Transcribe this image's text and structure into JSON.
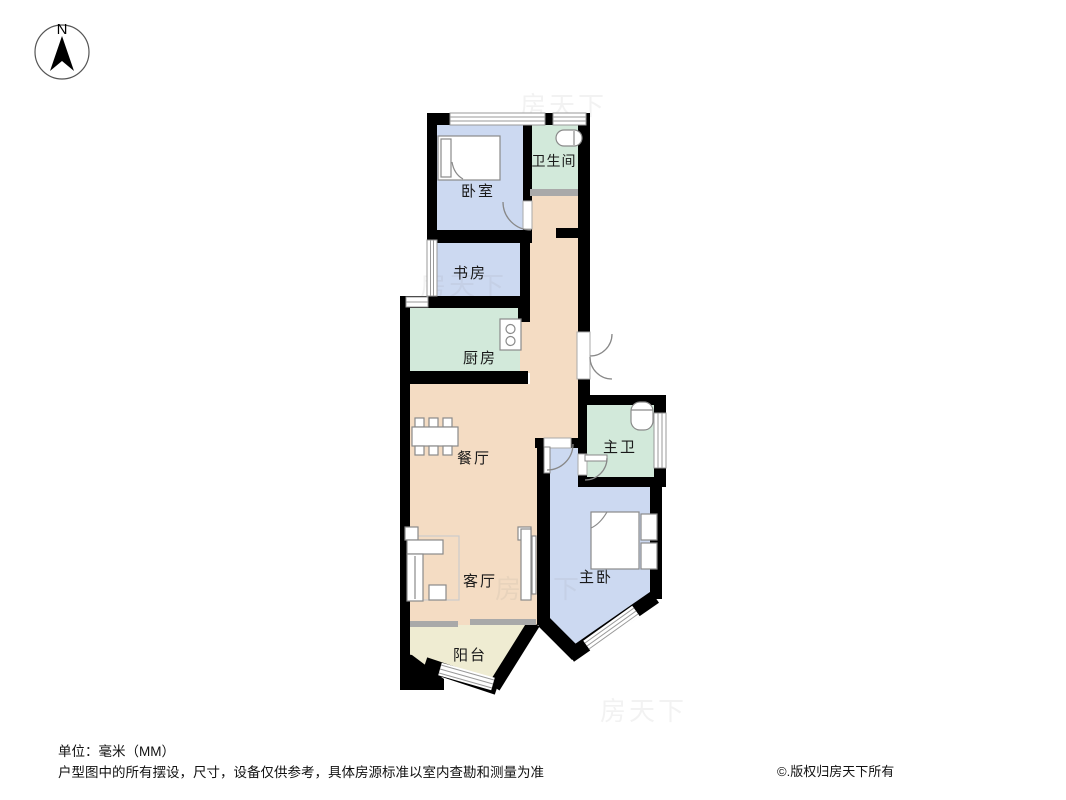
{
  "compass": {
    "label": "N"
  },
  "rooms": [
    {
      "id": "bedroom",
      "label": "卧室"
    },
    {
      "id": "bathroom",
      "label": "卫生间"
    },
    {
      "id": "study",
      "label": "书房"
    },
    {
      "id": "kitchen",
      "label": "厨房"
    },
    {
      "id": "dining",
      "label": "餐厅"
    },
    {
      "id": "master-bath",
      "label": "主卫"
    },
    {
      "id": "master-bedroom",
      "label": "主卧"
    },
    {
      "id": "living",
      "label": "客厅"
    },
    {
      "id": "balcony",
      "label": "阳台"
    }
  ],
  "colors": {
    "room_blue": "#ccd9f1",
    "room_teal": "#d2e9da",
    "room_beige": "#f4dcc3",
    "room_cream": "#efecd2",
    "wall": "#000000",
    "threshold": "#a9a9a9",
    "fixture_stroke": "#8a8a8a"
  },
  "watermark": {
    "text": "房天下"
  },
  "footer": {
    "unit_line": "单位：毫米（MM）",
    "disclaimer": "户型图中的所有摆设，尺寸，设备仅供参考，具体房源标准以室内查勘和测量为准",
    "copyright": "©.版权归房天下所有"
  }
}
